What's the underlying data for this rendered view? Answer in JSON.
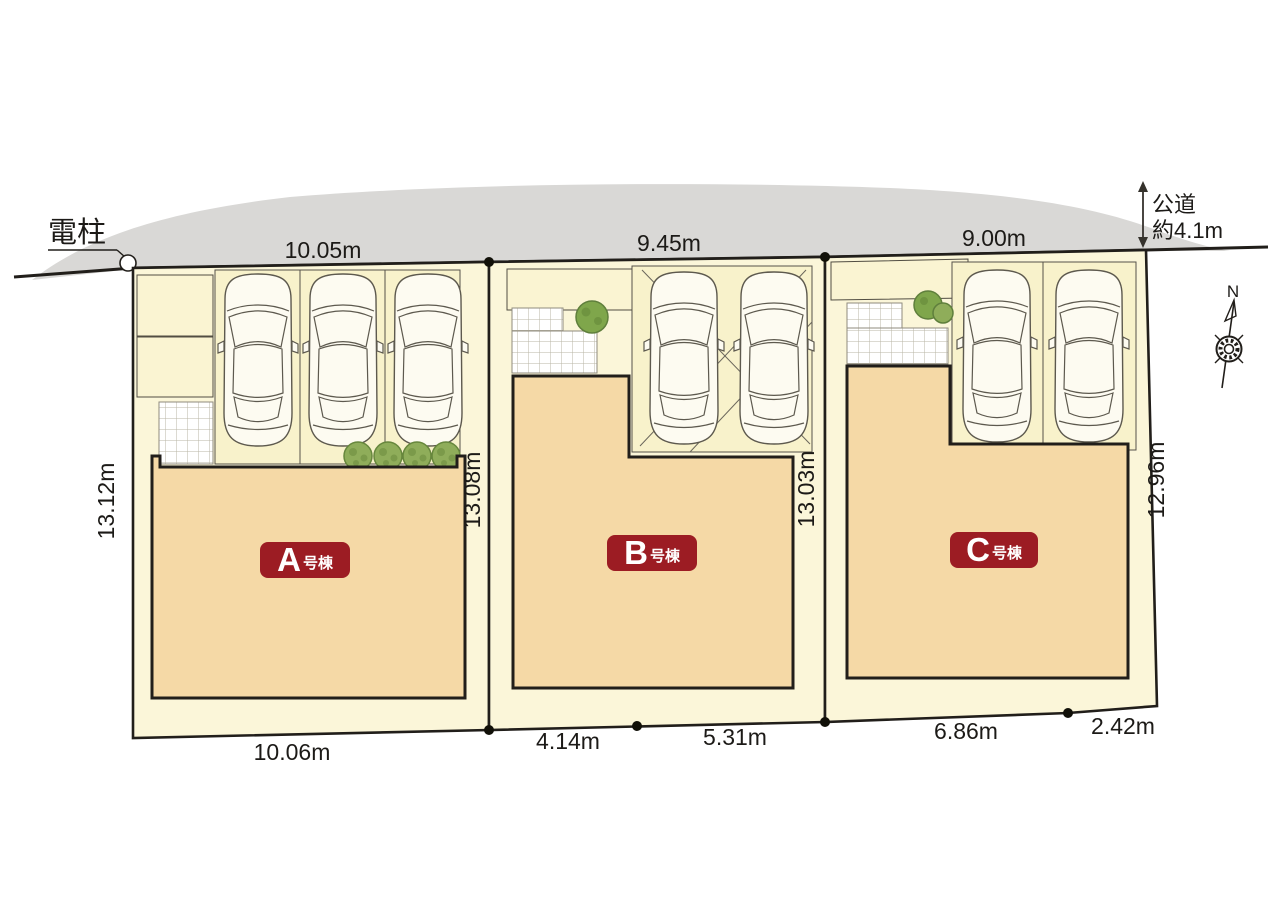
{
  "road": {
    "pole_label": "電柱",
    "road_type_label": "公道",
    "road_width_label": "約4.1m"
  },
  "compass": {
    "north": "N"
  },
  "lots": {
    "a": {
      "letter": "A",
      "suffix": "号棟",
      "top_width": "10.05m",
      "left_depth": "13.12m",
      "right_depth": "13.08m",
      "bottom1": "10.06m"
    },
    "b": {
      "letter": "B",
      "suffix": "号棟",
      "top_width": "9.45m",
      "right_depth": "13.03m",
      "bottom1": "4.14m",
      "bottom2": "5.31m"
    },
    "c": {
      "letter": "C",
      "suffix": "号棟",
      "top_width": "9.00m",
      "right_depth": "12.96m",
      "bottom1": "6.86m",
      "bottom2": "2.42m"
    }
  },
  "colors": {
    "road_gray": "#d9d8d6",
    "lot_cream": "#fbf6d9",
    "parking_cream": "#f8f2cb",
    "building_orange": "#f5d9a6",
    "label_red": "#9c1c23",
    "outline_dark": "#211e1a",
    "greenery": "#8fad5a"
  }
}
